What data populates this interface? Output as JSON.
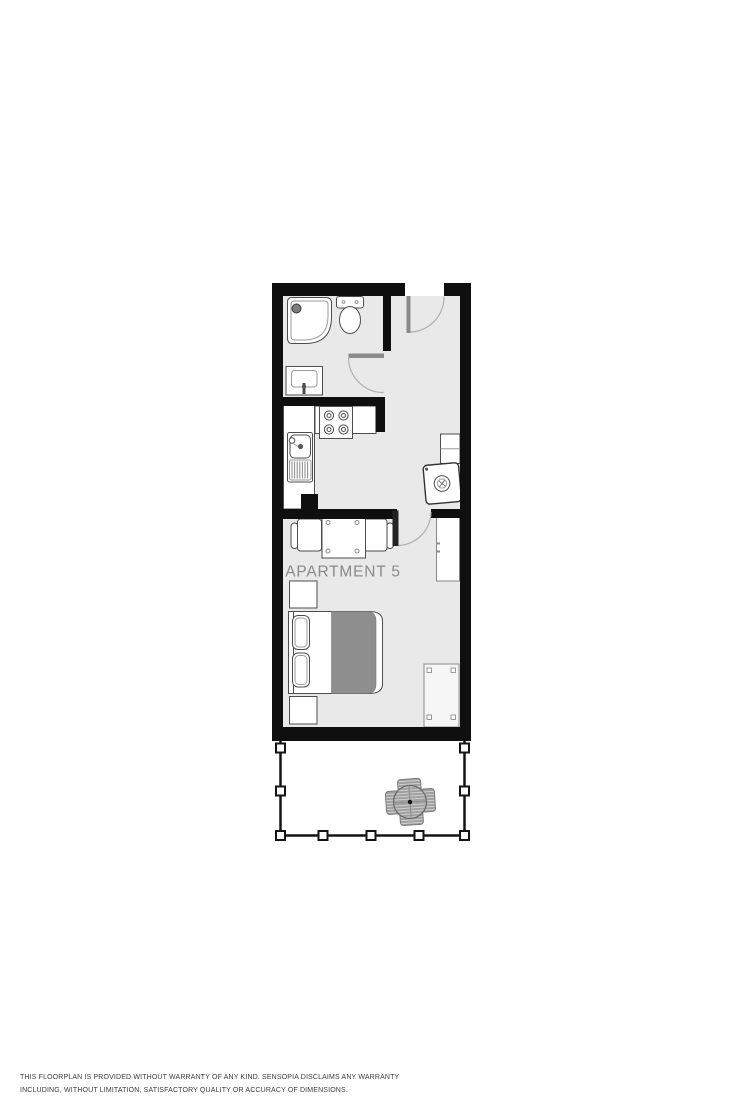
{
  "plan": {
    "apartment_label": "APARTMENT 5",
    "colors": {
      "wall": "#0f0f0f",
      "floor": "#e9e9e9",
      "duvet": "#8e8e8e",
      "fixture_outline": "#4d4d4d",
      "door_leaf": "#8a8a8a",
      "bedroom_door_leaf": "#222222",
      "label_text": "#8a8a8a",
      "patio_furniture": "#a0a0a0"
    },
    "fixtures": [
      "corner-shower",
      "toilet",
      "washbasin",
      "kitchen-counter",
      "stove",
      "kitchen-sink",
      "wall-cabinet",
      "washing-machine",
      "dining-table",
      "dining-chair-left",
      "dining-chair-right",
      "wardrobe",
      "nightstand-top",
      "double-bed",
      "nightstand-bottom",
      "desk",
      "terrace-railing",
      "patio-table",
      "patio-chairs"
    ]
  },
  "disclaimer": {
    "line1": "THIS FLOORPLAN IS PROVIDED WITHOUT WARRANTY OF ANY KIND. SENSOPIA DISCLAIMS ANY WARRANTY",
    "line2": "INCLUDING, WITHOUT LIMITATION, SATISFACTORY QUALITY OR ACCURACY OF DIMENSIONS."
  }
}
